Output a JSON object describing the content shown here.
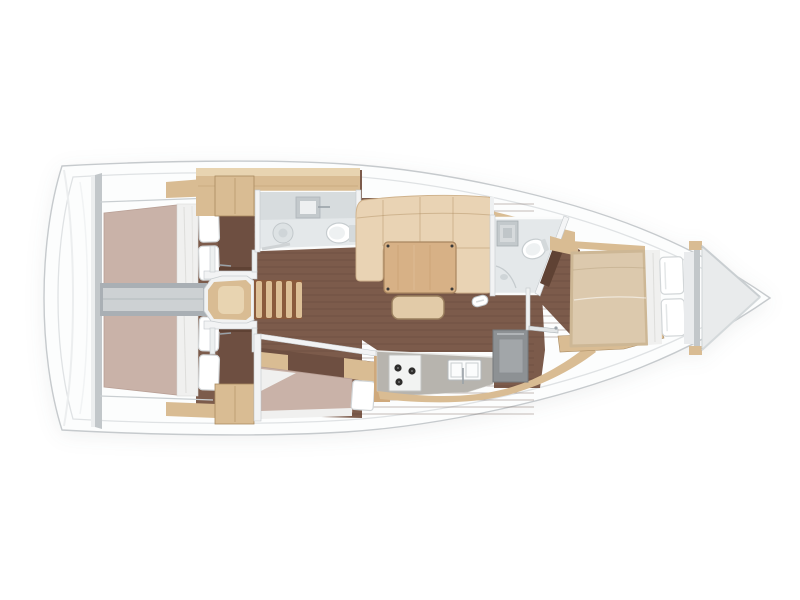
{
  "figure": {
    "type": "floor-plan",
    "subject": "sailboat-interior-top-view",
    "regions": [
      {
        "id": "stern-deck"
      },
      {
        "id": "aft-cabin-port"
      },
      {
        "id": "aft-cabin-starboard"
      },
      {
        "id": "engine-corridor"
      },
      {
        "id": "companionway-stairs"
      },
      {
        "id": "aft-head"
      },
      {
        "id": "saloon"
      },
      {
        "id": "saloon-sofa"
      },
      {
        "id": "saloon-table"
      },
      {
        "id": "settee-berth"
      },
      {
        "id": "galley"
      },
      {
        "id": "forward-head"
      },
      {
        "id": "forward-cabin"
      },
      {
        "id": "anchor-locker"
      }
    ]
  },
  "colors": {
    "background": "#ffffff",
    "hull_fill": "#fcfdfd",
    "hull_stroke": "#c6cacd",
    "inner_line": "#dfe2e4",
    "bulkhead_grey": "#c2c7ca",
    "wall_white": "#f2f3f4",
    "wall_stroke": "#c4c9cc",
    "floor_wood": "#7c5b4b",
    "floor_plank": "#5d4236",
    "floor_dark": "#6e4f41",
    "wood": "#d9bc93",
    "wood_light": "#e8d4b1",
    "wood_edge": "#a98a60",
    "wood_deep": "#cfa97c",
    "sofa": "#e9d3b4",
    "sofa_seam": "#b08d62",
    "table_wood": "#d7b186",
    "stool": "#e2cba8",
    "mattress": "#c9b2a8",
    "mattress_edge": "#b89f95",
    "duvet": "#dcc9ad",
    "bedding": "#f0f0ef",
    "pillow_fill": "#ffffff",
    "pillow_stroke": "#d2d6d8",
    "bath_floor": "#e4e8ea",
    "bath_counter": "#d7dcde",
    "fixture": "#c3c9cc",
    "toilet_stroke": "#c7cdd0",
    "corridor": "#a9afb4",
    "corridor_light": "#cdd1d3",
    "counter": "#b7b4ae",
    "stove": "#f2f3f2",
    "burner": "#2e2d2c",
    "fridge": "#8d9194",
    "fridge_inner": "#a2a6a9",
    "stair_base": "#8a5a3c",
    "stair_tread": "#dcbf96",
    "door_brown": "#5f4234",
    "handle": "#9aa2a8",
    "locker": "#e9ebec",
    "locker_edge": "#b9bec1"
  }
}
